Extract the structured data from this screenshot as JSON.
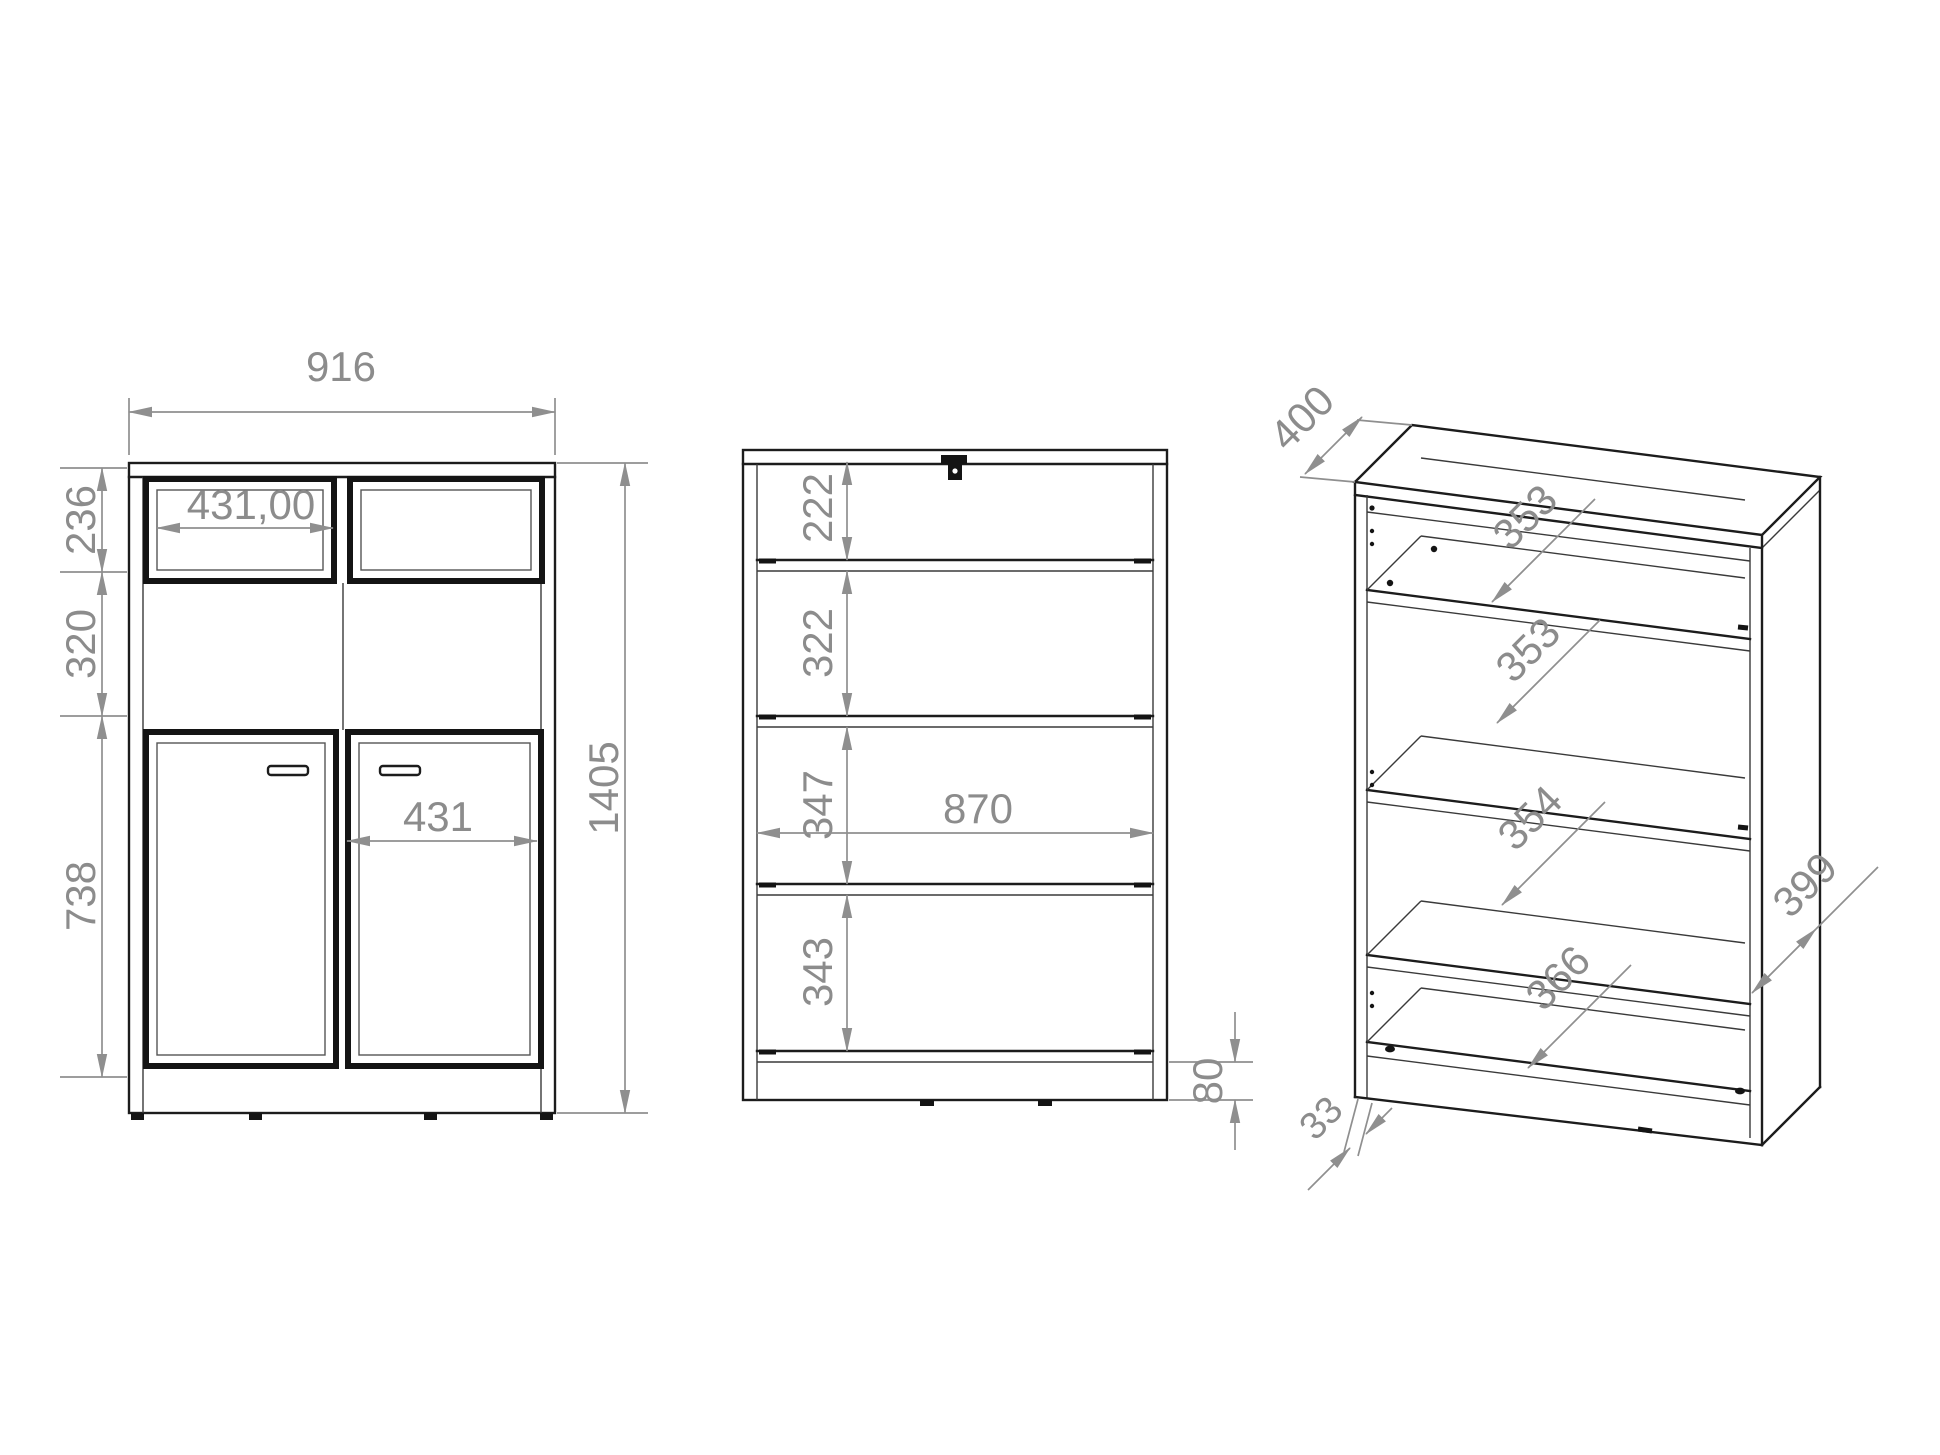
{
  "drawing": {
    "title": "cabinet-technical-drawing",
    "front_view": {
      "overall_width": "916",
      "overall_height": "1405",
      "top_door_width": "431,00",
      "bottom_door_width": "431",
      "segment_heights": [
        "236",
        "320",
        "738"
      ]
    },
    "section_view": {
      "compartment_heights": [
        "222",
        "322",
        "347",
        "343"
      ],
      "interior_width": "870",
      "base_height": "80"
    },
    "perspective_view": {
      "top_depth": "400",
      "shelf_depths": [
        "353",
        "353",
        "354"
      ],
      "bottom_shelf_depth": "366",
      "side_depth": "399",
      "base_inset": "33"
    },
    "colors": {
      "dimension_gray": "#8c8c8c",
      "line_black": "#1c1c1c",
      "background": "#ffffff"
    }
  }
}
